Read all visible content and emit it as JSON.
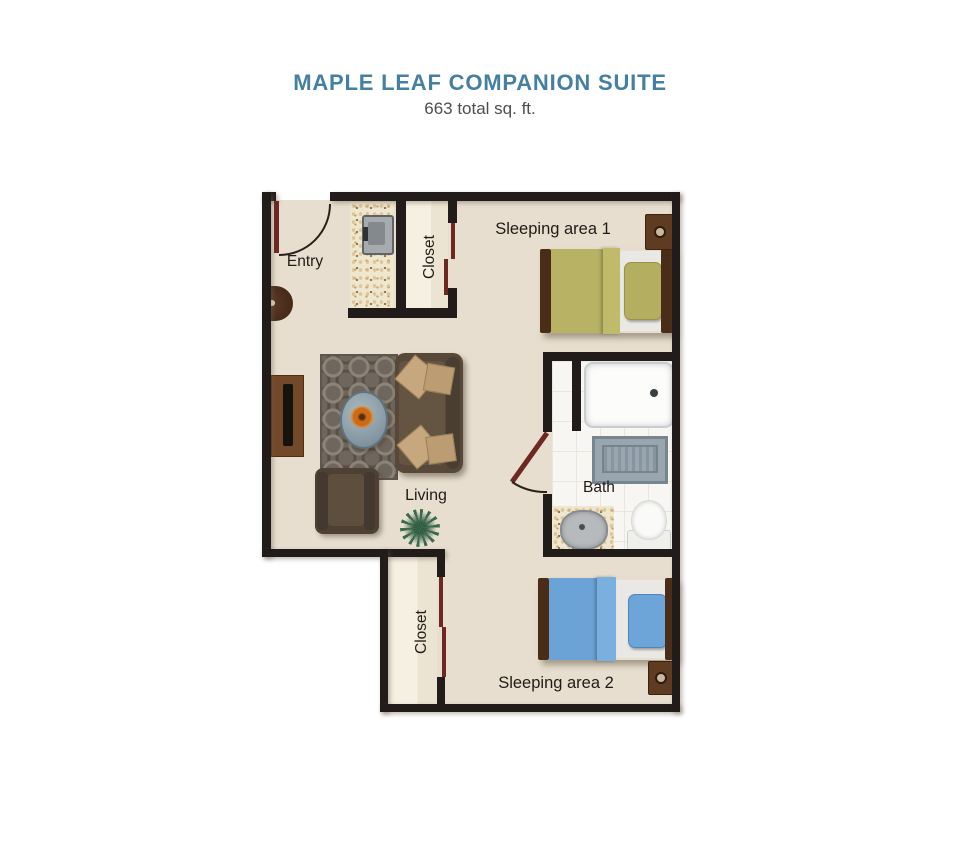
{
  "header": {
    "title": "MAPLE LEAF COMPANION SUITE",
    "subtitle": "663 total sq. ft."
  },
  "labels": {
    "entry": "Entry",
    "closet_top": "Closet",
    "closet_bottom": "Closet",
    "sleeping_area_1": "Sleeping area 1",
    "sleeping_area_2": "Sleeping area 2",
    "living": "Living",
    "bath": "Bath"
  },
  "colors": {
    "title_text": "#457fa2",
    "subtitle_text": "#4e4e4e",
    "wall": "#211b1a",
    "floor": "#e7decf",
    "closet_floor": "#f5f0e1",
    "door": "#6e2822",
    "bed1_blanket_olive": "#b7b264",
    "bed2_blanket_blue": "#6ca3d7",
    "bed_wood": "#4a2d19",
    "sofa_brown": "#57483a",
    "pillow_tan": "#c7a87e",
    "bath_mat": "#9aa6af"
  }
}
